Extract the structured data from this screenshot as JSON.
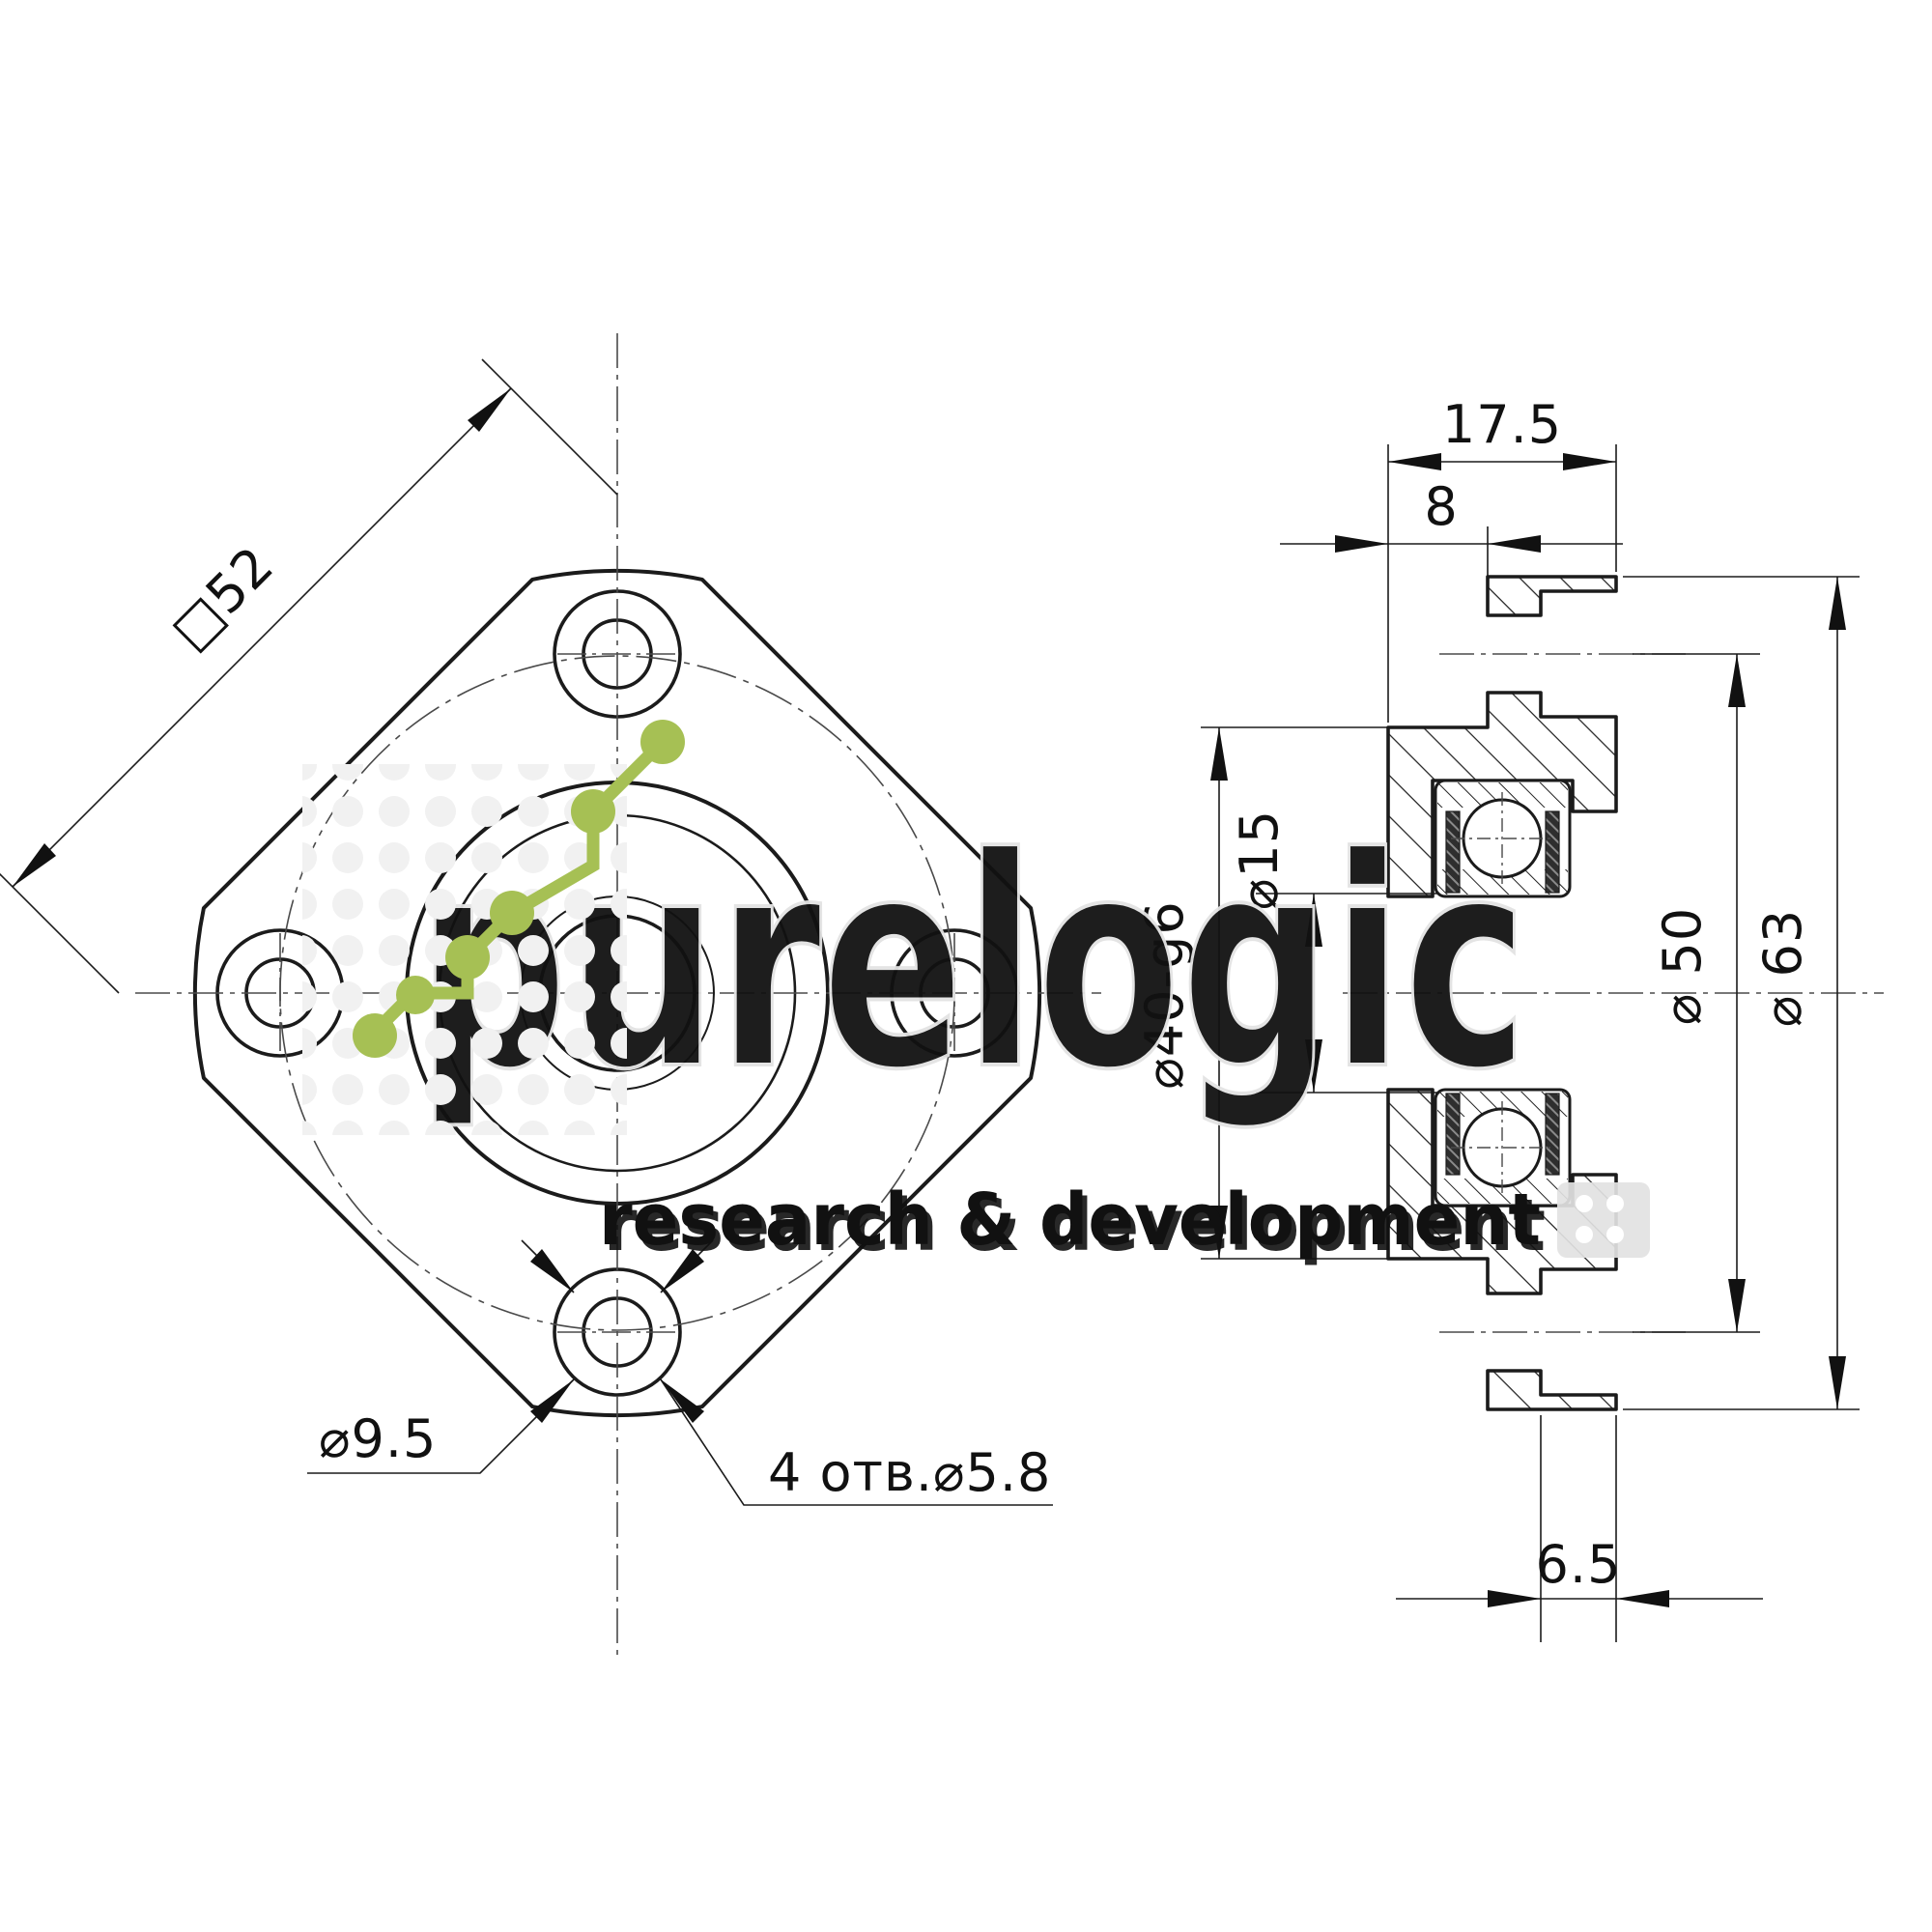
{
  "drawing": {
    "title": "Flanged bearing support unit — two-view technical drawing",
    "front_view": {
      "square_size_label": "□52",
      "counterbore_dia_label": "⌀9.5",
      "holes_note_label": "4 отв.⌀5.8"
    },
    "side_view": {
      "total_width_label": "17.5",
      "boss_depth_label": "8",
      "boss_dia_label": "⌀40-g6",
      "bore_dia_label": "⌀15",
      "bolt_circle_label": "⌀ 50",
      "outer_dia_label": "⌀ 63",
      "counterbore_depth_label": "6.5"
    },
    "colors": {
      "line": "#1b1b1b",
      "centerline": "#4a4a4a",
      "watermark_gray": "#ececec",
      "accent_green": "#a6c054"
    }
  },
  "watermark": {
    "brand": "purelogic",
    "tagline": "research & development"
  }
}
